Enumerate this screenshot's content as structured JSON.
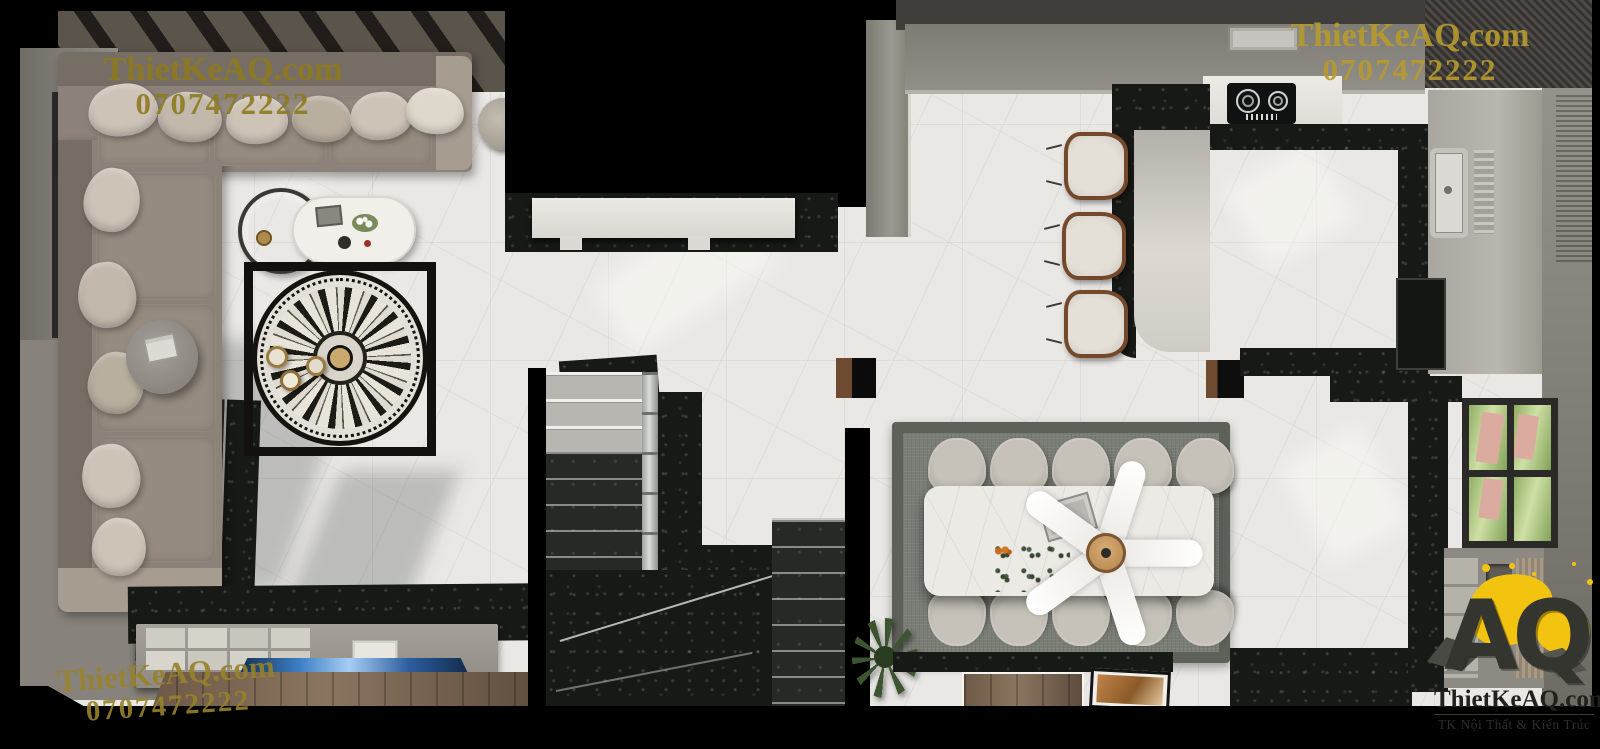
{
  "watermarks": {
    "color": "#a38c28",
    "top_left": {
      "site": "ThietKeAQ.com",
      "phone": "0707472222"
    },
    "top_right": {
      "site": "ThietKeAQ.com",
      "phone": "0707472222"
    },
    "bottom_left": {
      "site": "ThietKeAQ.com",
      "phone": "0707472222"
    }
  },
  "logo": {
    "monogram": "AQ",
    "site": "ThietKeAQ.com",
    "tagline": "TK Nội Thất & Kiến Trúc",
    "accent_color": "#f2c410",
    "ink_color": "#33332d"
  },
  "scene": {
    "type": "top-down 3D interior render",
    "rooms": [
      "living-room",
      "foyer",
      "staircase",
      "dining-room",
      "kitchen"
    ],
    "object_counts": {
      "dining_chairs": 10,
      "bar_stools": 3,
      "fan_blades": 5,
      "windows": 3
    },
    "palette": {
      "floor_marble": "#e9e8e5",
      "dark_marble": "#171916",
      "wall_gray": "#8d8a84",
      "sofa_taupe": "#8d8279",
      "rug_gray": "#6f716b",
      "wood_brown": "#77624e",
      "tv_glow_blue": "#4a8fd4",
      "garden_green": "#8fae62"
    }
  }
}
